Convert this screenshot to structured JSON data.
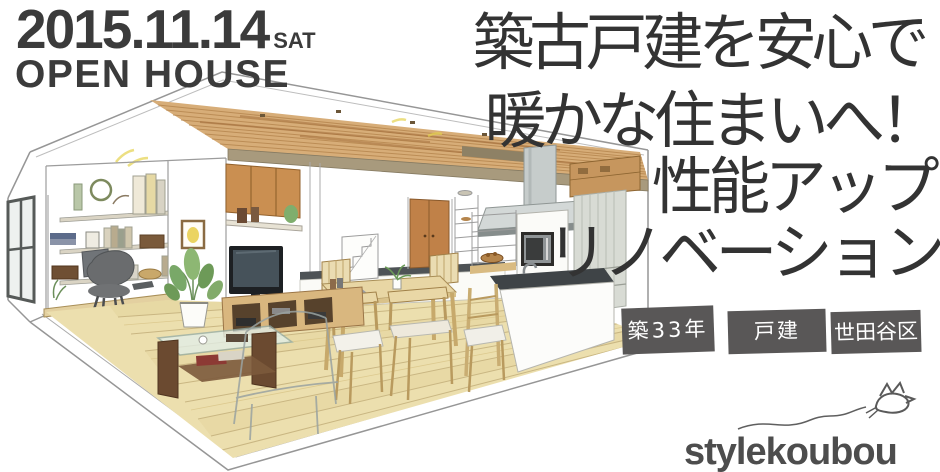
{
  "event": {
    "date": "2015.11.14",
    "day": "SAT",
    "title": "OPEN HOUSE"
  },
  "headline": {
    "line1": "築古戸建を安心で",
    "line2": "暖かな住まいへ！",
    "line3": "性能アップ",
    "line4": "リノベーション"
  },
  "tags": [
    {
      "label": "築33年"
    },
    {
      "label": "戸建"
    },
    {
      "label": "世田谷区"
    }
  ],
  "brand": {
    "logo_text": "stylekoubou"
  },
  "illustration": {
    "alt": "hand-drawn interior perspective of renovated LDK: study nook with bookshelves, TV wall, dining set and island kitchen under a wood-plank ceiling"
  },
  "colors": {
    "headline_text": "#333333",
    "date_text": "#3b3b3b",
    "tag_background": "#595757",
    "tag_text": "#ffffff",
    "logo_text": "#4d4d4d",
    "ceiling_wood": "#d7ad78",
    "floor_wood": "#ecdfae",
    "cabinet_wood": "#ca8f51",
    "counter_dark": "#3f4447",
    "steel": "#c6cccb"
  }
}
